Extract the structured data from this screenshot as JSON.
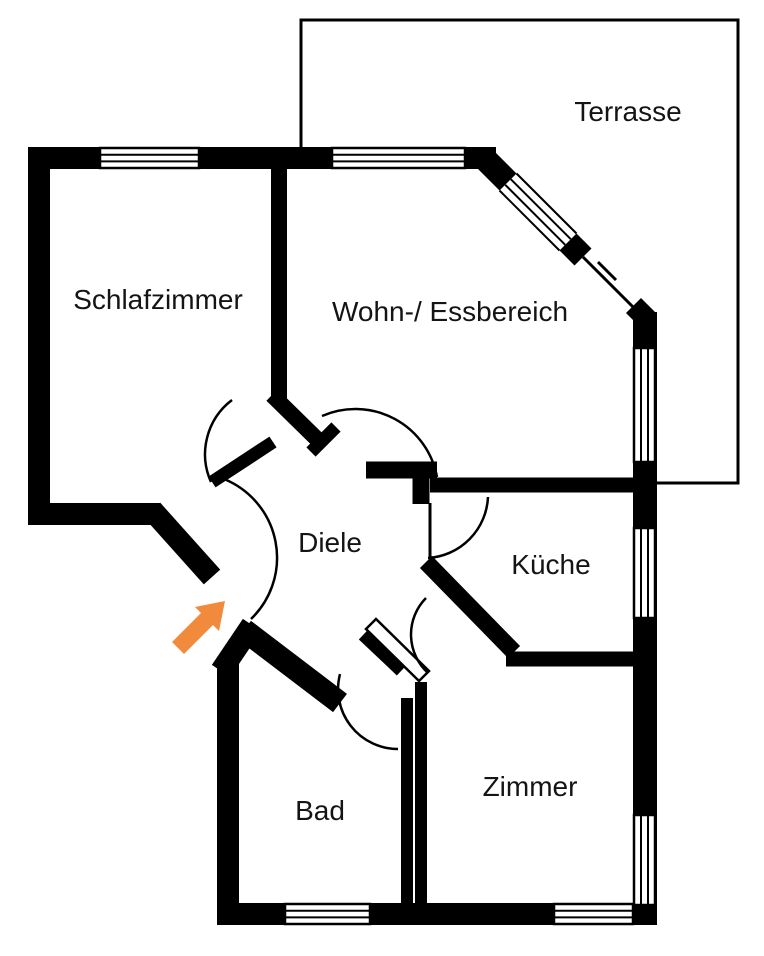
{
  "floorplan": {
    "type": "apartment-floor-plan",
    "rooms": [
      {
        "id": "terrasse",
        "label": "Terrasse"
      },
      {
        "id": "schlafzimmer",
        "label": "Schlafzimmer"
      },
      {
        "id": "wohn-essbereich",
        "label": "Wohn-/ Essbereich"
      },
      {
        "id": "diele",
        "label": "Diele"
      },
      {
        "id": "kueche",
        "label": "Küche"
      },
      {
        "id": "bad",
        "label": "Bad"
      },
      {
        "id": "zimmer",
        "label": "Zimmer"
      }
    ],
    "colors": {
      "walls": "#000000",
      "background": "#ffffff",
      "arrow": "#F28A3D",
      "label": "#141414"
    },
    "annotations": {
      "entrance_arrow": "orange arrow pointing at apartment entrance door"
    }
  }
}
